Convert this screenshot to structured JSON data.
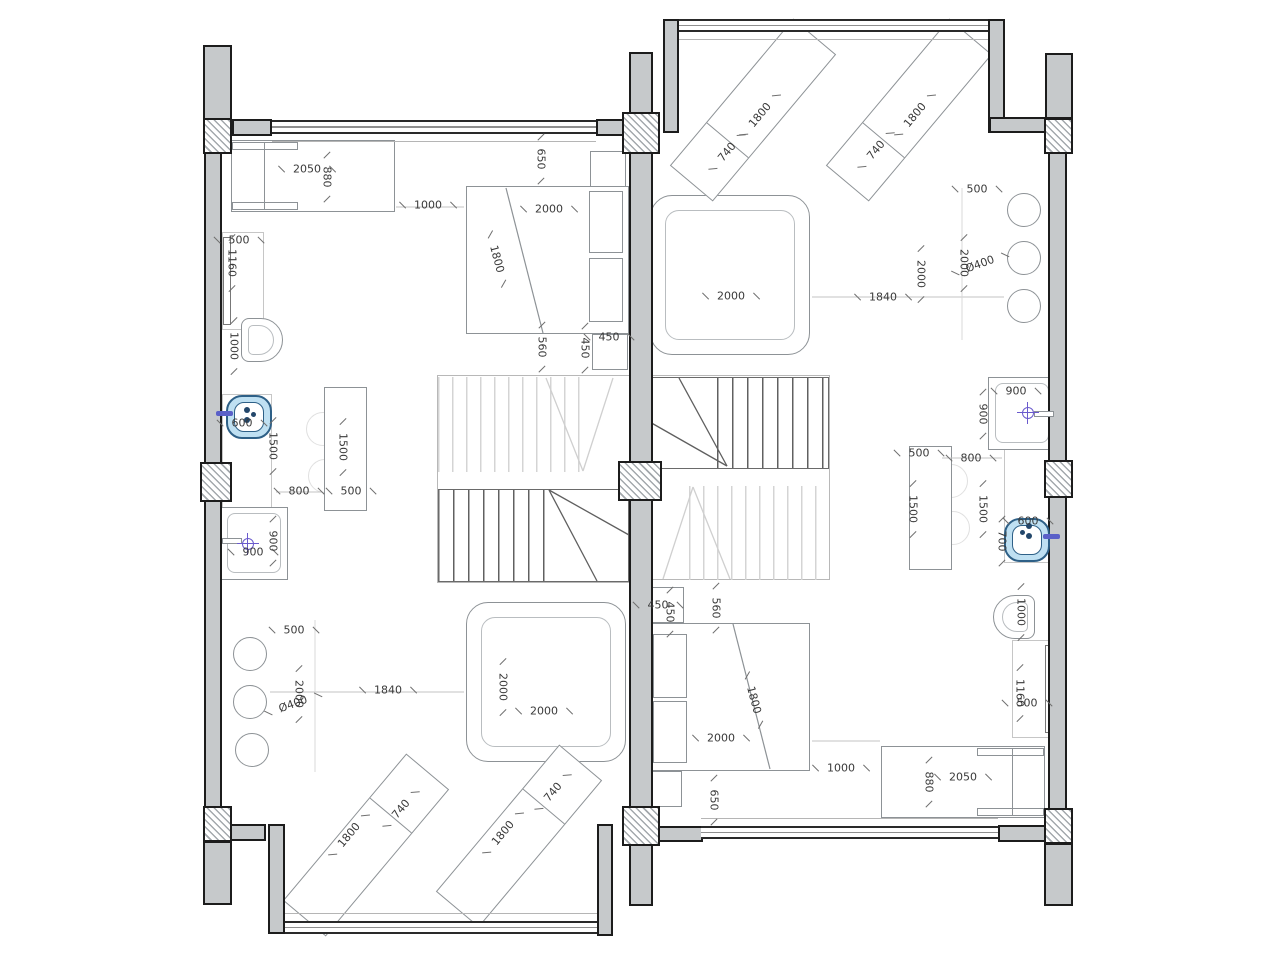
{
  "meta": {
    "drawing_type": "Architectural floor plan: two mirrored residential units sharing a central party wall, each with kitchen, shower, beds, lounge chairs and a winder staircase",
    "units": "millimeters"
  },
  "colors": {
    "wall_fill": "#c6c9cb",
    "wall_outline": "#1c1c1c",
    "furniture_line": "#8d9296",
    "light_line": "#c6c6c6",
    "stair_dark": "#606060",
    "stair_light": "#d4d4d4",
    "sink_fill": "#bfe0f2",
    "sink_border": "#2e6087",
    "faucet": "#5a60c8",
    "crosshair": "#6a5acd",
    "dim_text": "#3a3a3a"
  },
  "dimension_labels": [
    {
      "t": "2050",
      "x": 307,
      "y": 169,
      "r": 0
    },
    {
      "t": "880",
      "x": 327,
      "y": 177,
      "r": 90
    },
    {
      "t": "1000",
      "x": 428,
      "y": 205,
      "r": 0
    },
    {
      "t": "2000",
      "x": 549,
      "y": 209,
      "r": 0
    },
    {
      "t": "1800",
      "x": 497,
      "y": 259,
      "r": 75
    },
    {
      "t": "650",
      "x": 541,
      "y": 159,
      "r": 90
    },
    {
      "t": "560",
      "x": 542,
      "y": 347,
      "r": 90
    },
    {
      "t": "450",
      "x": 585,
      "y": 348,
      "r": 90
    },
    {
      "t": "450",
      "x": 609,
      "y": 337,
      "r": 0
    },
    {
      "t": "500",
      "x": 239,
      "y": 240,
      "r": 0
    },
    {
      "t": "1160",
      "x": 232,
      "y": 263,
      "r": 90
    },
    {
      "t": "1000",
      "x": 234,
      "y": 346,
      "r": 90
    },
    {
      "t": "600",
      "x": 242,
      "y": 423,
      "r": 0
    },
    {
      "t": "1500",
      "x": 273,
      "y": 446,
      "r": 90
    },
    {
      "t": "1500",
      "x": 343,
      "y": 447,
      "r": 90
    },
    {
      "t": "500",
      "x": 351,
      "y": 491,
      "r": 0
    },
    {
      "t": "800",
      "x": 299,
      "y": 491,
      "r": 0
    },
    {
      "t": "900",
      "x": 253,
      "y": 552,
      "r": 0
    },
    {
      "t": "900",
      "x": 273,
      "y": 541,
      "r": 90
    },
    {
      "t": "500",
      "x": 294,
      "y": 630,
      "r": 0
    },
    {
      "t": "2000",
      "x": 299,
      "y": 694,
      "r": 90
    },
    {
      "t": "Ø400",
      "x": 293,
      "y": 704,
      "r": -20
    },
    {
      "t": "1840",
      "x": 388,
      "y": 690,
      "r": 0
    },
    {
      "t": "2000",
      "x": 503,
      "y": 687,
      "r": 90
    },
    {
      "t": "2000",
      "x": 544,
      "y": 711,
      "r": 0
    },
    {
      "t": "740",
      "x": 401,
      "y": 809,
      "r": -50
    },
    {
      "t": "1800",
      "x": 349,
      "y": 835,
      "r": -50
    },
    {
      "t": "740",
      "x": 553,
      "y": 792,
      "r": -50
    },
    {
      "t": "1800",
      "x": 503,
      "y": 833,
      "r": -50
    },
    {
      "t": "1800",
      "x": 760,
      "y": 115,
      "r": -50
    },
    {
      "t": "740",
      "x": 727,
      "y": 152,
      "r": -50
    },
    {
      "t": "1800",
      "x": 915,
      "y": 115,
      "r": -50
    },
    {
      "t": "740",
      "x": 876,
      "y": 150,
      "r": -50
    },
    {
      "t": "500",
      "x": 977,
      "y": 189,
      "r": 0
    },
    {
      "t": "2000",
      "x": 964,
      "y": 263,
      "r": 90
    },
    {
      "t": "Ø400",
      "x": 980,
      "y": 264,
      "r": -20
    },
    {
      "t": "1840",
      "x": 883,
      "y": 297,
      "r": 0
    },
    {
      "t": "2000",
      "x": 921,
      "y": 274,
      "r": 90
    },
    {
      "t": "2000",
      "x": 731,
      "y": 296,
      "r": 0
    },
    {
      "t": "900",
      "x": 1016,
      "y": 391,
      "r": 0
    },
    {
      "t": "900",
      "x": 983,
      "y": 414,
      "r": 90
    },
    {
      "t": "800",
      "x": 971,
      "y": 458,
      "r": 0
    },
    {
      "t": "500",
      "x": 919,
      "y": 453,
      "r": 0
    },
    {
      "t": "1500",
      "x": 913,
      "y": 509,
      "r": 90
    },
    {
      "t": "1500",
      "x": 983,
      "y": 509,
      "r": 90
    },
    {
      "t": "700",
      "x": 1002,
      "y": 541,
      "r": 90
    },
    {
      "t": "600",
      "x": 1028,
      "y": 521,
      "r": 0
    },
    {
      "t": "1000",
      "x": 1021,
      "y": 612,
      "r": 90
    },
    {
      "t": "1160",
      "x": 1020,
      "y": 693,
      "r": 90
    },
    {
      "t": "500",
      "x": 1027,
      "y": 703,
      "r": 0
    },
    {
      "t": "2050",
      "x": 963,
      "y": 777,
      "r": 0
    },
    {
      "t": "880",
      "x": 929,
      "y": 782,
      "r": 90
    },
    {
      "t": "1000",
      "x": 841,
      "y": 768,
      "r": 0
    },
    {
      "t": "2000",
      "x": 721,
      "y": 738,
      "r": 0
    },
    {
      "t": "1800",
      "x": 754,
      "y": 700,
      "r": 75
    },
    {
      "t": "650",
      "x": 714,
      "y": 800,
      "r": 90
    },
    {
      "t": "560",
      "x": 716,
      "y": 608,
      "r": 90
    },
    {
      "t": "450",
      "x": 658,
      "y": 605,
      "r": 0
    },
    {
      "t": "450",
      "x": 670,
      "y": 612,
      "r": 90
    }
  ]
}
